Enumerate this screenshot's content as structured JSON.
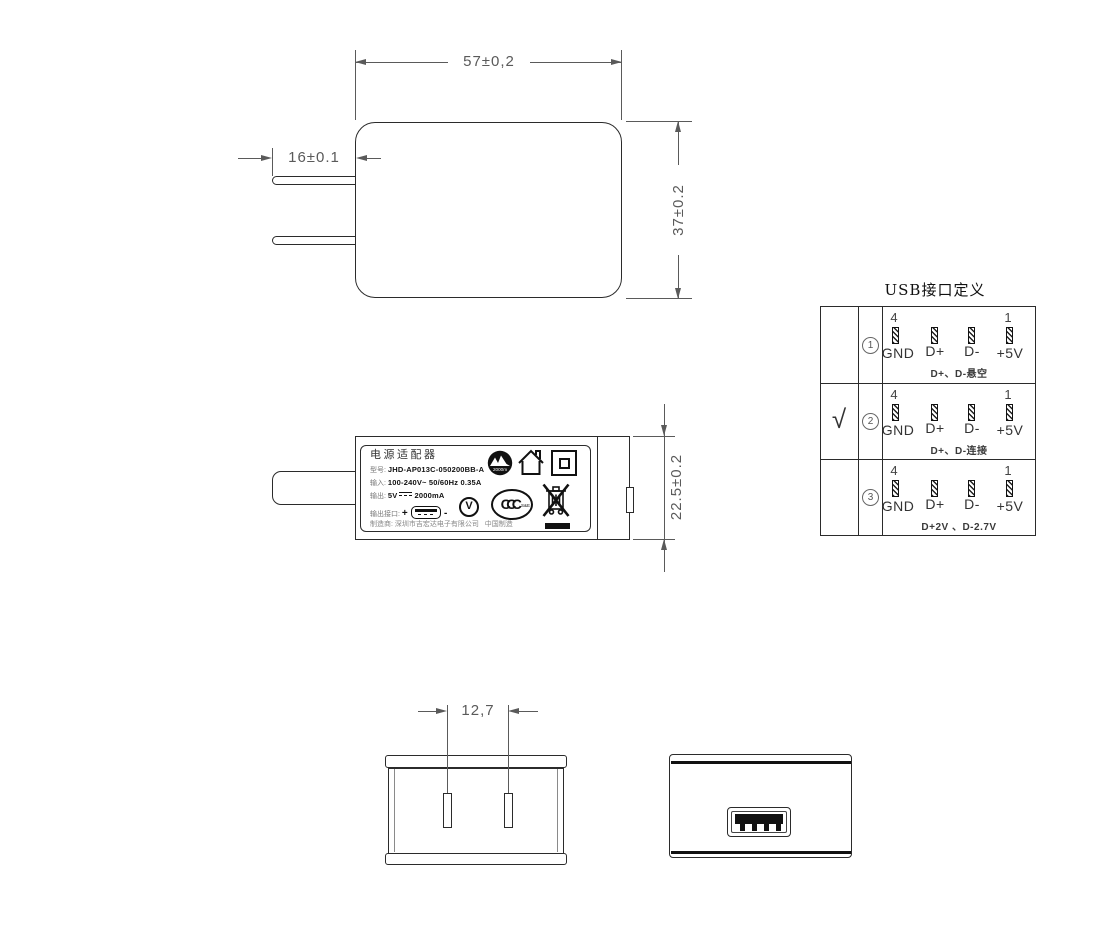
{
  "drawing": {
    "front_view": {
      "width_dim": "57±0,2",
      "height_dim": "37±0.2",
      "prong_dim": "16±0.1"
    },
    "side_view": {
      "thickness_dim": "22.5±0.2"
    },
    "bottom_view": {
      "prong_pitch_dim": "12,7"
    },
    "label": {
      "title": "电源适配器",
      "model_label": "型号:",
      "model_value": "JHD-AP013C-050200BB-A",
      "input_label": "输入:",
      "input_value": "100-240V~  50/60Hz  0.35A",
      "output_label": "输出:",
      "output_v": "5V",
      "output_ma": "2000mA",
      "port_label": "输出接口:",
      "port_plus": "+",
      "port_minus": "-",
      "mfr_label": "制造商:",
      "mfr_value": "深圳市吉宏达电子有限公司",
      "made_in": "中国制造",
      "altitude_text": "2000m",
      "efficiency_letter": "V",
      "ccc_text": "CCC",
      "ccc_small": "S&E"
    },
    "usb_table": {
      "title": "USB接口定义",
      "pin_top_left": "4",
      "pin_top_right": "1",
      "pin_labels": [
        "GND",
        "D+",
        "D-",
        "+5V"
      ],
      "check_mark": "√",
      "rows": [
        {
          "selected": false,
          "num": "1",
          "note": "D+、D-悬空"
        },
        {
          "selected": true,
          "num": "2",
          "note": "D+、D-连接"
        },
        {
          "selected": false,
          "num": "3",
          "note": "D+2V 、D-2.7V"
        }
      ]
    }
  },
  "colors": {
    "line": "#2b2b2b",
    "dimension": "#5a5a5a",
    "ink": "#111111"
  }
}
